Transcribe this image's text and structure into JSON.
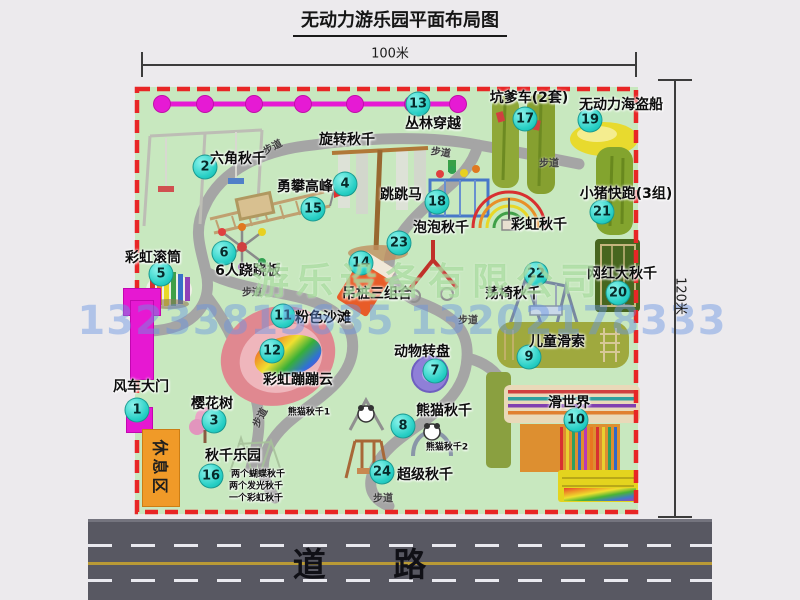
{
  "title": "无动力游乐园平面布局图",
  "dim_top": "100米",
  "dim_right": "120米",
  "road": "道 路",
  "rest_area": "休息区",
  "watermark": {
    "company": "游乐设备有限公司",
    "phones": "13233815635 13202178333"
  },
  "markers": [
    {
      "n": 1,
      "label": "风车大门",
      "cx": 137,
      "cy": 410,
      "lx": 141,
      "ly": 386
    },
    {
      "n": 2,
      "label": "六角秋千",
      "cx": 205,
      "cy": 167,
      "lx": 238,
      "ly": 158
    },
    {
      "n": 3,
      "label": "樱花树",
      "cx": 214,
      "cy": 421,
      "lx": 212,
      "ly": 403
    },
    {
      "n": 4,
      "label": "旋转秋千",
      "cx": 345,
      "cy": 184,
      "lx": 347,
      "ly": 139
    },
    {
      "n": 5,
      "label": "彩虹滚筒",
      "cx": 161,
      "cy": 274,
      "lx": 153,
      "ly": 257
    },
    {
      "n": 6,
      "label": "6人跷跷板",
      "cx": 224,
      "cy": 253,
      "lx": 248,
      "ly": 270
    },
    {
      "n": 7,
      "label": "动物转盘",
      "cx": 435,
      "cy": 371,
      "lx": 422,
      "ly": 351
    },
    {
      "n": 8,
      "label": "熊猫秋千",
      "cx": 403,
      "cy": 426,
      "lx": 444,
      "ly": 410
    },
    {
      "n": 9,
      "label": "儿童滑索",
      "cx": 529,
      "cy": 357,
      "lx": 557,
      "ly": 341
    },
    {
      "n": 10,
      "label": "滑世界",
      "cx": 576,
      "cy": 420,
      "lx": 569,
      "ly": 402
    },
    {
      "n": 11,
      "label": "粉色沙滩",
      "cx": 283,
      "cy": 316,
      "lx": 323,
      "ly": 317
    },
    {
      "n": 12,
      "label": "彩虹蹦蹦云",
      "cx": 272,
      "cy": 351,
      "lx": 298,
      "ly": 379
    },
    {
      "n": 13,
      "label": "丛林穿越",
      "cx": 418,
      "cy": 104,
      "lx": 433,
      "ly": 123
    },
    {
      "n": 14,
      "label": "吊桩三组合",
      "cx": 361,
      "cy": 263,
      "lx": 377,
      "ly": 293
    },
    {
      "n": 15,
      "label": "勇攀高峰",
      "cx": 313,
      "cy": 209,
      "lx": 305,
      "ly": 186
    },
    {
      "n": 16,
      "label": "秋千乐园",
      "cx": 211,
      "cy": 476,
      "lx": 233,
      "ly": 455
    },
    {
      "n": 17,
      "label": "坑爹车(2套)",
      "cx": 525,
      "cy": 119,
      "lx": 529,
      "ly": 97
    },
    {
      "n": 18,
      "label": "跳跳马",
      "cx": 437,
      "cy": 202,
      "lx": 401,
      "ly": 194
    },
    {
      "n": 19,
      "label": "无动力海盗船",
      "cx": 590,
      "cy": 120,
      "lx": 621,
      "ly": 104
    },
    {
      "n": 20,
      "label": "网红大秋千",
      "cx": 618,
      "cy": 293,
      "lx": 622,
      "ly": 273
    },
    {
      "n": 21,
      "label": "小猪快跑(3组)",
      "cx": 602,
      "cy": 212,
      "lx": 626,
      "ly": 193
    },
    {
      "n": 22,
      "label": "荡椅秋千",
      "cx": 536,
      "cy": 274,
      "lx": 513,
      "ly": 293
    },
    {
      "n": 23,
      "label": "泡泡秋千",
      "cx": 399,
      "cy": 243,
      "lx": 441,
      "ly": 227
    },
    {
      "n": 24,
      "label": "超级秋千",
      "cx": 382,
      "cy": 472,
      "lx": 425,
      "ly": 474
    }
  ],
  "extra_labels": [
    {
      "text": "彩虹秋千",
      "x": 539,
      "y": 224,
      "fs": 14
    },
    {
      "text": "熊猫秋千1",
      "x": 309,
      "y": 411,
      "fs": 9
    },
    {
      "text": "熊猫秋千2",
      "x": 447,
      "y": 446,
      "fs": 9
    },
    {
      "text": "两个蝴蝶秋千",
      "x": 258,
      "y": 473,
      "fs": 9
    },
    {
      "text": "两个发光秋千",
      "x": 256,
      "y": 485,
      "fs": 9
    },
    {
      "text": "一个彩虹秋千",
      "x": 256,
      "y": 497,
      "fs": 9
    }
  ],
  "path_labels": [
    {
      "text": "步道",
      "x": 272,
      "y": 146,
      "rot": -28
    },
    {
      "text": "步道",
      "x": 441,
      "y": 151,
      "rot": 8
    },
    {
      "text": "步道",
      "x": 549,
      "y": 162,
      "rot": 0
    },
    {
      "text": "步道",
      "x": 252,
      "y": 291,
      "rot": 0
    },
    {
      "text": "步道",
      "x": 468,
      "y": 319,
      "rot": 0
    },
    {
      "text": "步道",
      "x": 259,
      "y": 417,
      "rot": -62
    },
    {
      "text": "步道",
      "x": 383,
      "y": 497,
      "rot": 0
    }
  ]
}
